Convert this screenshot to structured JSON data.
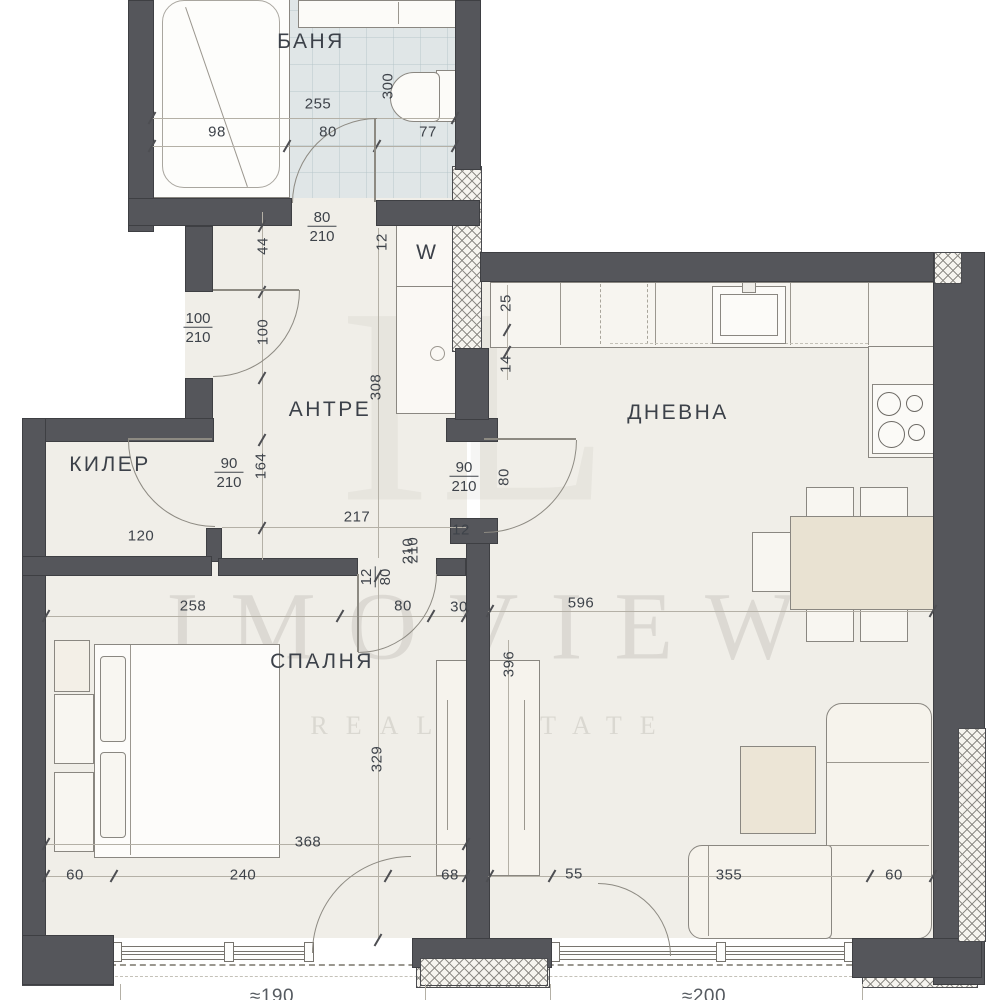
{
  "plan": {
    "watermark": {
      "monogram": "IL",
      "brand": "IMOVIEW",
      "tagline": "REAL ESTATE"
    },
    "rooms": {
      "bathroom": "БАНЯ",
      "hall": "АНТРЕ",
      "closet": "КИЛЕР",
      "living": "ДНЕВНА",
      "bedroom": "СПАЛНЯ"
    },
    "appliances": {
      "washer": "W"
    },
    "doors": {
      "bath": {
        "w": "80",
        "h": "210"
      },
      "entry": {
        "w": "100",
        "h": "210"
      },
      "closet": {
        "w": "90",
        "h": "210"
      },
      "living": {
        "w": "90",
        "h": "210"
      },
      "bedroom": {
        "stub": "12",
        "w": "80",
        "h": "210"
      }
    },
    "dims": {
      "bath_total": "255",
      "bath_tub": "98",
      "bath_door": "80",
      "bath_wc": "77",
      "bath_depth": "300",
      "hall_seg_44": "44",
      "hall_stub_12": "12",
      "entry_side_100": "100",
      "hall_len_308": "308",
      "closet_depth_164": "164",
      "closet_width_120": "120",
      "kitchen_25": "25",
      "kitchen_14": "14",
      "living_door_side_80": "80",
      "living_stub_12": "12",
      "hall_width_217": "217",
      "hall_door_h_210": "210",
      "bedroom_wall_258": "258",
      "bedroom_door_80": "80",
      "bedroom_stub_30": "30",
      "living_width_596": "596",
      "living_depth_396": "396",
      "bedroom_depth_329": "329",
      "bedroom_width_368": "368",
      "bedroom_pier_60": "60",
      "bedroom_window_240": "240",
      "bedroom_pier_68": "68",
      "living_pier_55": "55",
      "living_window_355": "355",
      "living_pier_60": "60",
      "balcony_left": "≈190",
      "balcony_right": "≈200"
    }
  }
}
